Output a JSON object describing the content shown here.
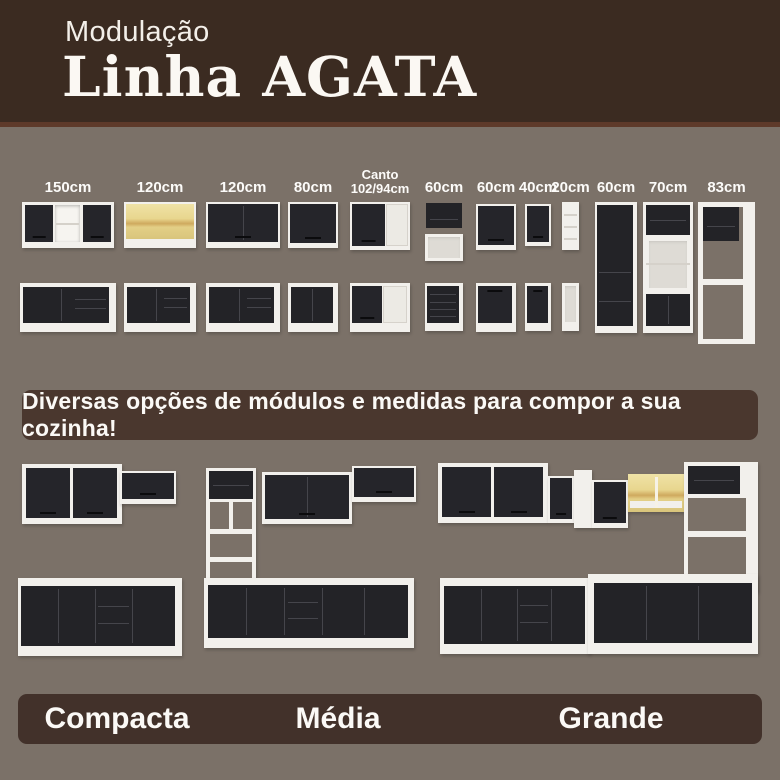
{
  "header": {
    "subtitle": "Modulação",
    "title": "Linha AGATA"
  },
  "modules": {
    "items": [
      {
        "label": "150cm",
        "type": "wall cabinet with open centre + base cabinet with drawers"
      },
      {
        "label": "120cm",
        "type": "wood-front wall cabinet + base cabinet with drawers"
      },
      {
        "label": "120cm",
        "type": "two-door wall cabinet + base cabinet with drawers"
      },
      {
        "label": "80cm",
        "type": "wall cabinet + two-door base cabinet"
      },
      {
        "label": "Canto",
        "label2": "102/94cm",
        "type": "corner wall cabinet + corner base cabinet"
      },
      {
        "label": "60cm",
        "type": "compact wall cabinet with open niche + drawer base unit"
      },
      {
        "label": "60cm",
        "type": "wall cabinet + single-door base cabinet"
      },
      {
        "label": "40cm",
        "type": "narrow wall cabinet + narrow base cabinet"
      },
      {
        "label": "20cm",
        "type": "open shelf tower + open base niche"
      },
      {
        "label": "60cm",
        "type": "tall pantry cabinet"
      },
      {
        "label": "70cm",
        "type": "tall tower with open shelves"
      },
      {
        "label": "83cm",
        "type": "tall open appliance frame"
      }
    ]
  },
  "banner": {
    "text": "Diversas opções de módulos e medidas para compor a sua cozinha!"
  },
  "legend": {
    "items": [
      {
        "label": "Compacta"
      },
      {
        "label": "Média"
      },
      {
        "label": "Grande"
      }
    ]
  },
  "colors": {
    "header_bg": "#3b2b21",
    "accent_line": "#5e3a2a",
    "body_bg": "#7b7168",
    "panel_bg": "#4a372e",
    "legend_bg": "#42312a",
    "cabinet_black": "#232327",
    "carcass_white": "#f2f0ec",
    "wood": "#e8d68e",
    "text": "#fbf9f6"
  }
}
